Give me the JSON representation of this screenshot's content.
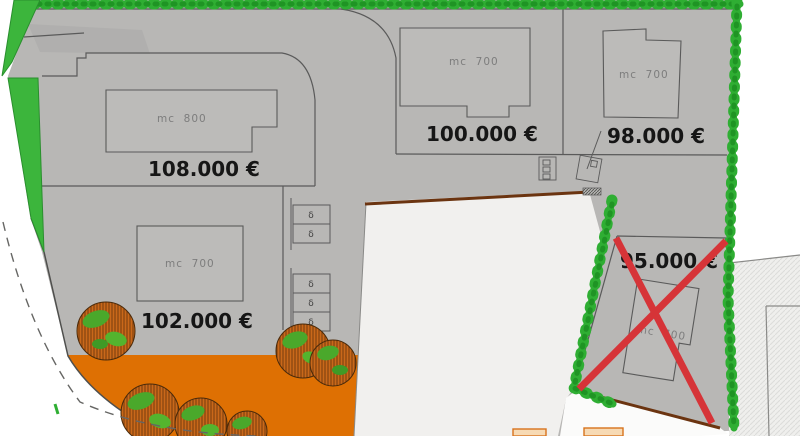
{
  "lots": [
    {
      "label": "lot-108000",
      "price": "108.000 €",
      "building_label": "mc  800"
    },
    {
      "label": "lot-100000",
      "price": "100.000 €",
      "building_label": "mc  700"
    },
    {
      "label": "lot-98000",
      "price": "98.000 €",
      "building_label": "mc  700"
    },
    {
      "label": "lot-102000",
      "price": "102.000 €",
      "building_label": "mc  700"
    },
    {
      "label": "lot-95000",
      "price": "95.000 €",
      "building_label": "mc  700",
      "crossed_out": true
    }
  ],
  "parking_stalls": {
    "symbol": "δ",
    "upper_group_count": 2,
    "lower_group_count": 3
  },
  "colors": {
    "ground_gray": "#b8b7b5",
    "hedge_green": "#2fae33",
    "orchard_orange": "#de7003",
    "cross_red": "#d63438",
    "empty_lot_white": "#f1f0ee",
    "boundary_gray": "#5a5a5a",
    "soil_brown": "#6b3410"
  }
}
